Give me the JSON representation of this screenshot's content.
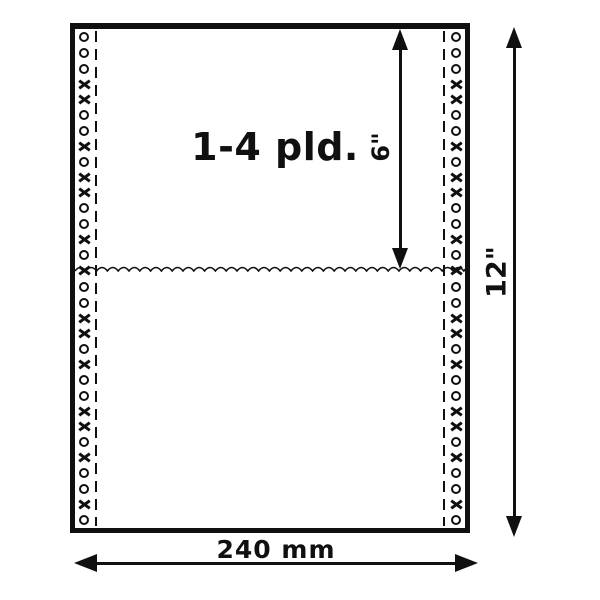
{
  "diagram": {
    "ply_label": "1-4 pld.",
    "section_height_label": "6\"",
    "total_height_label": "12\"",
    "width_label": "240 mm"
  },
  "colors": {
    "ink": "#101010",
    "background": "#ffffff"
  },
  "decor": {
    "tractor_holes_per_strip": 32,
    "tractor_hole_pattern": "oooxxooxoxxooxoxooxxoxooxxoxooxo"
  }
}
